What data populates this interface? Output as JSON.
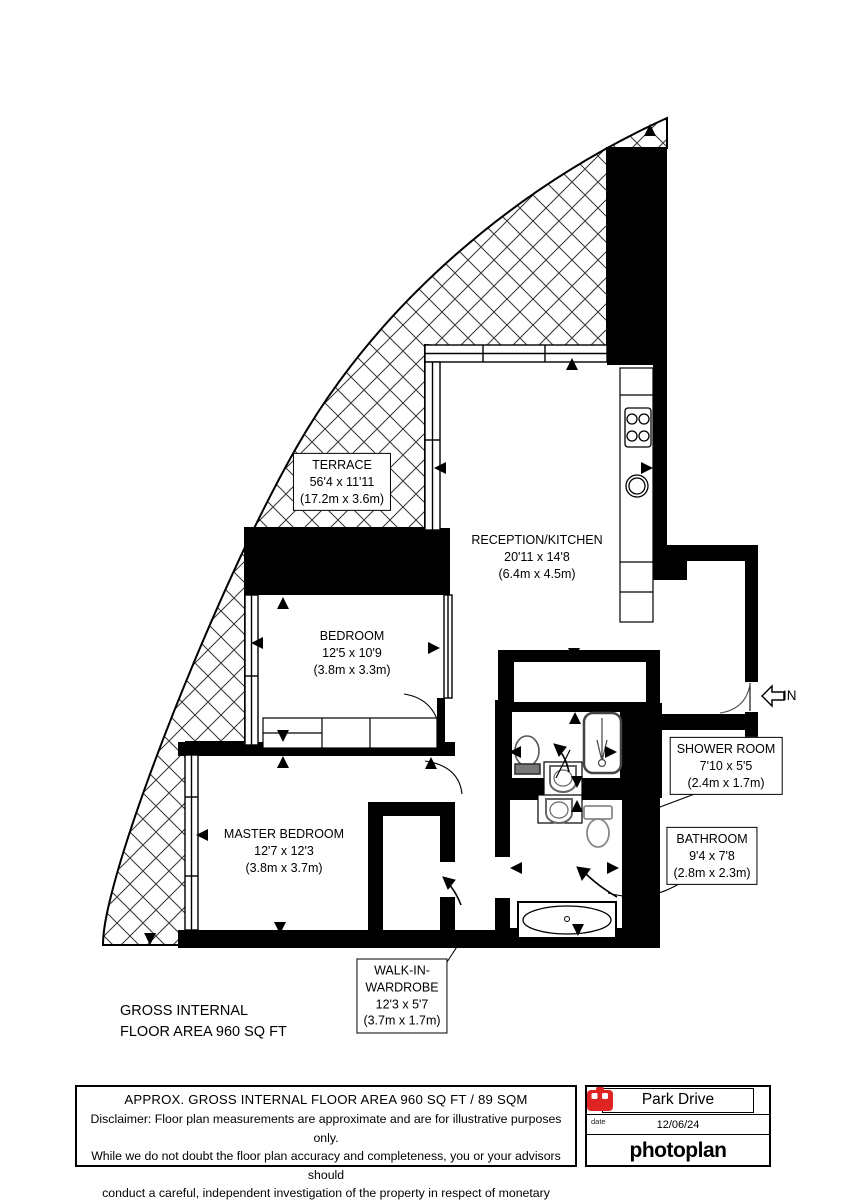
{
  "labels": {
    "terrace": {
      "name": "TERRACE",
      "imperial": "56'4 x 11'11",
      "metric": "(17.2m x 3.6m)"
    },
    "reception": {
      "name": "RECEPTION/KITCHEN",
      "imperial": "20'11 x 14'8",
      "metric": "(6.4m x 4.5m)"
    },
    "bedroom": {
      "name": "BEDROOM",
      "imperial": "12'5 x 10'9",
      "metric": "(3.8m x 3.3m)"
    },
    "master": {
      "name": "MASTER BEDROOM",
      "imperial": "12'7 x 12'3",
      "metric": "(3.8m x 3.7m)"
    },
    "wardrobe": {
      "name_line1": "WALK-IN-",
      "name_line2": "WARDROBE",
      "imperial": "12'3 x 5'7",
      "metric": "(3.7m x 1.7m)"
    },
    "shower": {
      "name": "SHOWER ROOM",
      "imperial": "7'10 x 5'5",
      "metric": "(2.4m x 1.7m)"
    },
    "bathroom": {
      "name": "BATHROOM",
      "imperial": "9'4 x 7'8",
      "metric": "(2.8m x 2.3m)"
    }
  },
  "area_note": {
    "line1": "GROSS INTERNAL",
    "line2": "FLOOR AREA 960 SQ FT"
  },
  "entrance_label": "IN",
  "footer": {
    "area_title": "APPROX. GROSS INTERNAL FLOOR AREA 960 SQ FT / 89 SQM",
    "disclaimer_line1": "Disclaimer: Floor plan measurements are approximate and are for illustrative purposes only.",
    "disclaimer_line2": "While we do not doubt the floor plan accuracy and completeness, you or your advisors should",
    "disclaimer_line3": "conduct a careful, independent investigation of the property in respect of monetary valuation",
    "property_name": "Park Drive",
    "date_label": "date",
    "date_value": "12/06/24",
    "brand": "photoplan"
  },
  "colors": {
    "wall": "#000000",
    "brand_red": "#e02423",
    "paper": "#ffffff",
    "hatch_line": "#333333"
  }
}
